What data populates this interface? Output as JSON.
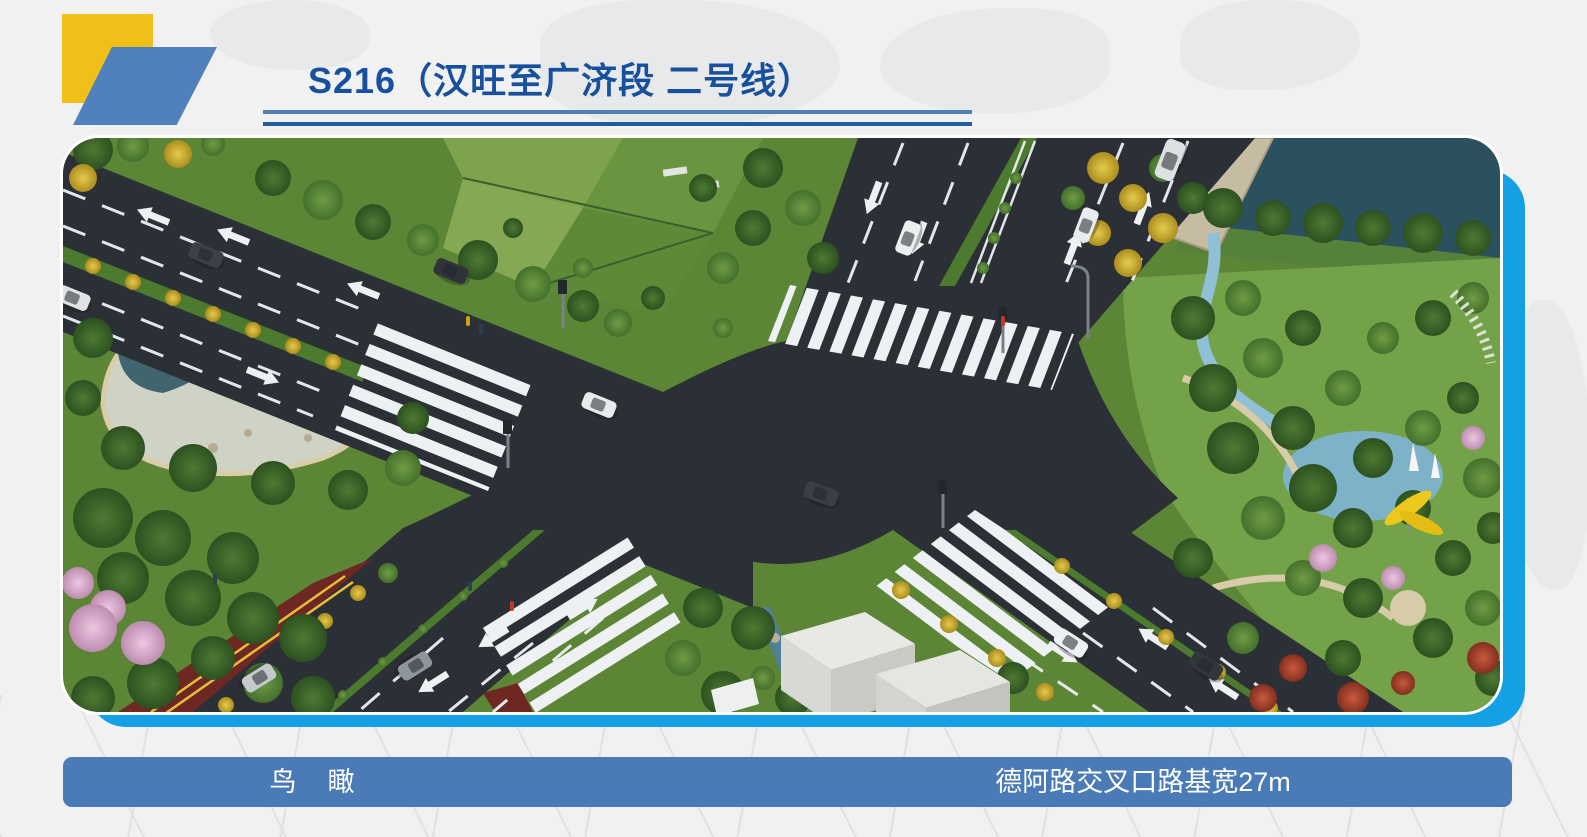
{
  "slide": {
    "title": "S216（汉旺至广济段 二号线）",
    "captions": {
      "left": "鸟　瞰",
      "right": "德阿路交叉口路基宽27m"
    }
  },
  "colors": {
    "title_text": "#17519E",
    "rule_top": "#4E7FB5",
    "rule_bottom": "#1E5C9E",
    "logo_yellow": "#F0C019",
    "logo_blue": "#5081BC",
    "photo_accent_azure": "#14A0E4",
    "caption_bar_blue": "#4A7BB7",
    "caption_text": "#FFFFFF",
    "asphalt": "#2B3036",
    "greenway_red": "#6E2722",
    "marking_white": "#EEF1F4"
  }
}
